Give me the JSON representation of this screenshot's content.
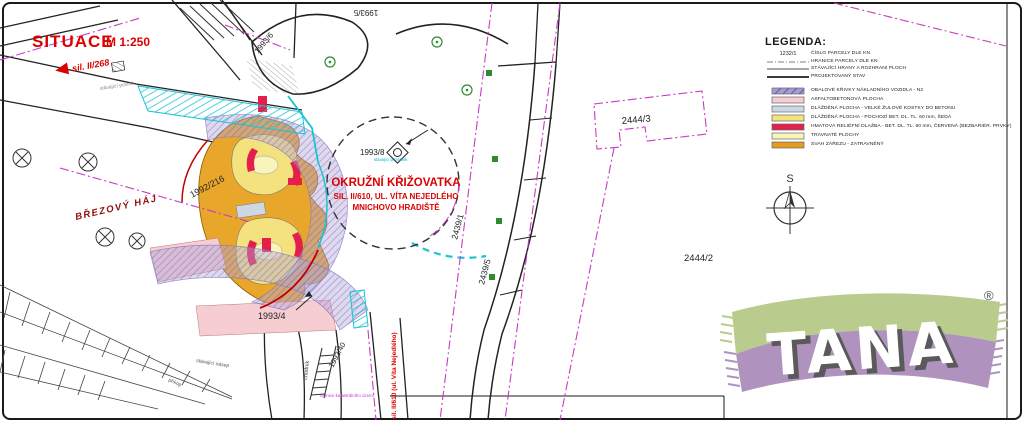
{
  "title": {
    "text": "SITUACE",
    "scale": "M 1:250"
  },
  "map_labels": {
    "road_nw": "sil. II/268",
    "existing_surface": "stávající povrch",
    "grove": "BŘEZOVÝ HÁJ",
    "existing_embankment": "stávající násep",
    "ditch": "příkop",
    "sidewalk": "chodník",
    "existing_parcel_note": "stávající pozemek",
    "road_south": "sil. II/610 (ul. Víta Nejedlého)",
    "cadastral_boundary": "hranice katastrálního území",
    "compass_north": "S"
  },
  "parcels": {
    "p1993_5": "1993/5",
    "p1993_6": "1993/6",
    "p1993_8": "1993/8",
    "p1993_4": "1993/4",
    "p1993_40": "1993/40",
    "p1992_216": "1992/216",
    "p2444_3": "2444/3",
    "p2444_2": "2444/2",
    "p2439_1": "2439/1",
    "p2439_5": "2439/5"
  },
  "roundabout_label": {
    "line1": "OKRUŽNÍ KŘIŽOVATKA",
    "line2": "SIL. II/610, UL. VÍTA NEJEDLÉHO",
    "line3": "MNICHOVO HRADIŠTĚ"
  },
  "legend": {
    "title": "LEGENDA:",
    "line_items": [
      {
        "sample": "1232/1",
        "label": "ČÍSLO PARCELY DLE KN"
      },
      {
        "label": "HRANICE PARCELY DLE KN"
      },
      {
        "label": "STÁVAJÍCÍ HRANY A ROZHRANÍ PLOCH"
      },
      {
        "label": "PROJEKTOVANÝ STAV"
      }
    ],
    "area_items": [
      {
        "color": "#a89bd4",
        "label": "OBALOVÉ KŘIVKY NÁKLADNÍHO VOZIDLA - N2"
      },
      {
        "color": "#f6ced2",
        "label": "ASFALTOBETONOVÁ PLOCHA"
      },
      {
        "color": "#ccd9e4",
        "label": "DLÁŽDĚNÁ PLOCHA - VELKÉ ŽULOVÉ KOSTKY DO BETONU"
      },
      {
        "color": "#f3e27d",
        "label": "DLÁŽDĚNÁ PLOCHA - POCHOZÍ BET. DL. TL. 60 mm, ŠEDÁ"
      },
      {
        "color": "#e61e4d",
        "label": "HMATOVÁ RELIÉFNÍ DLAŽBA - BET. DL. TL. 60 mm, ČERVENÁ (BEZBARIÉR. PRVKY)"
      },
      {
        "color": "#f8f4bc",
        "label": "TRAVNATÉ PLOCHY"
      },
      {
        "color": "#e69b1e",
        "label": "SVAH ZÁŘEZU - ZATRAVNĚNÝ"
      }
    ]
  },
  "logo": {
    "text": "TANA",
    "registered": "®"
  },
  "colors": {
    "red_text": "#dd0000",
    "dark_red": "#8e1010",
    "magenta": "#c63bc6",
    "cyan": "#19c3d4",
    "orange": "#e69b1e",
    "yellow": "#f3e27d",
    "pale_yellow": "#f8f4bc",
    "pink": "#f6ced2",
    "purple": "#a89bd4",
    "paving_red": "#e61e4d",
    "logo_green": "#b9cb8d",
    "logo_purple": "#b092bf"
  }
}
